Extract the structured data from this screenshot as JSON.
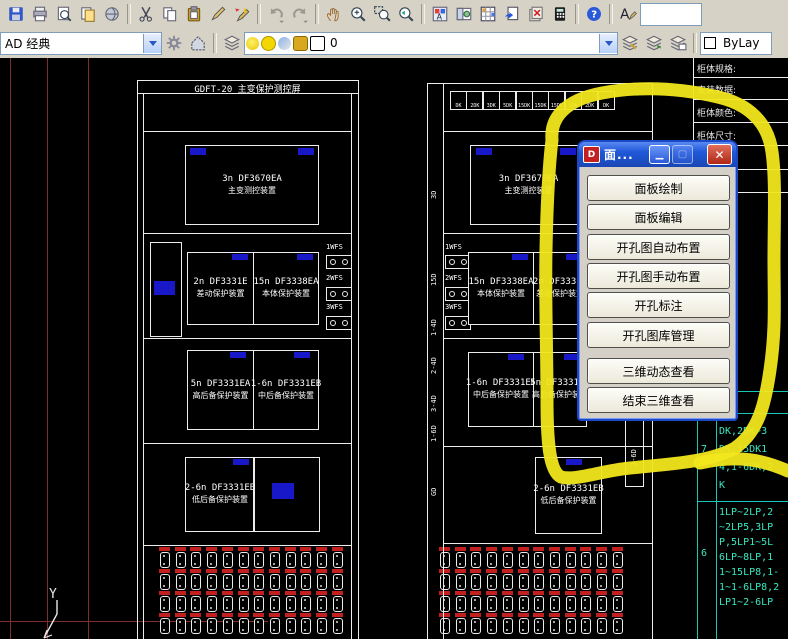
{
  "toolbars": {
    "standard_icons": [
      "save",
      "plot",
      "plot-preview",
      "publish",
      "etransmit",
      "|",
      "cut",
      "copy",
      "paste",
      "edit-pencil",
      "match-properties",
      "|",
      "undo",
      "redo",
      "|",
      "pan",
      "zoom-realtime",
      "zoom-window",
      "zoom-previous",
      "|",
      "properties",
      "designcenter",
      "tool-palettes",
      "sheet-set-manager",
      "markup-set-manager",
      "quickcalc",
      "|",
      "help",
      "|",
      "text-style"
    ],
    "workspace_value": "AD 经典",
    "row2_icons_left": [
      "workspace-settings",
      "my-workspace"
    ],
    "layer_toolbar_icon": "layer-properties-manager",
    "layer_combo": {
      "current_layer": "0",
      "state_icons": [
        "bulb-icon",
        "sun-icon",
        "viewport-freeze-icon",
        "lock-icon",
        "color-swatch"
      ]
    },
    "row2_icons_right": [
      "layer-make-current",
      "layer-previous",
      "layer-states-manager"
    ],
    "color_value": "ByLay"
  },
  "dialog": {
    "title": "面...",
    "buttons": [
      "面板绘制",
      "面板编辑",
      "开孔图自动布置",
      "开孔图手动布置",
      "开孔标注",
      "开孔图库管理",
      "三维动态查看",
      "结束三维查看"
    ]
  },
  "drawing": {
    "highlight_color": "#f2e71c",
    "panel_left": {
      "title": "GDFT-20 主变保护测控屏",
      "modules": [
        {
          "code": "3n DF3670EA",
          "name": "主变测控装置"
        },
        {
          "code": "2n DF3331E",
          "name": "差动保护装置"
        },
        {
          "code": "15n DF3338EA",
          "name": "本体保护装置"
        },
        {
          "code": "5n DF3331EA",
          "name": "高后备保护装置"
        },
        {
          "code": "1-6n DF3331EB",
          "name": "中后备保护装置"
        },
        {
          "code": "2-6n DF3331EB",
          "name": "低后备保护装置"
        }
      ],
      "wfs_labels": [
        "1WFS",
        "2WFS",
        "3WFS"
      ],
      "terminal_rows": 4,
      "terminals_per_row": 12
    },
    "panel_right": {
      "dk_boxes": [
        "DK",
        "2DK",
        "3DK",
        "5DK",
        "15DK",
        "15DK",
        "15DK",
        "1DK",
        "2DK",
        "DK"
      ],
      "side_labels": [
        "3D",
        "15D",
        "1-4D",
        "2-4D",
        "3-4D",
        "1-6D",
        "GD"
      ],
      "tag_2_6d": "2-6D",
      "wfs_labels": [
        "1WFS",
        "2WFS",
        "3WFS"
      ],
      "modules": [
        {
          "code": "3n DF3670EA",
          "name": "主变测控装置"
        },
        {
          "code": "15n DF3338EA",
          "name": "本体保护装置"
        },
        {
          "code": "2n DF3331E",
          "name": "差动保护装置"
        },
        {
          "code": "1-6n DF3331EB",
          "name": "中后备保护装置"
        },
        {
          "code": "5n DF3331EA",
          "name": "高后备保护装置"
        },
        {
          "code": "2-6n DF3331EB",
          "name": "低后备保护装置"
        }
      ],
      "terminal_rows": 4,
      "terminals_per_row": 12
    },
    "spec_table": {
      "rows": [
        "柜体规格:",
        "安装数据:",
        "柜体颜色:",
        "柜体尺寸:",
        "母线规格(",
        "规格 :"
      ]
    },
    "signal_table": {
      "header": "FS~3WF",
      "groups": [
        {
          "no": "7",
          "lines": [
            "DK,2DK~3",
            "DK,15DK1",
            "4,1-6DK,2",
            "K"
          ]
        },
        {
          "no": "6",
          "lines": [
            "1LP~2LP,2",
            "~2LP5,3LP",
            "P,5LP1~5L",
            "6LP~8LP,1",
            "1~15LP8,1-",
            "1~1-6LP8,2",
            "LP1~2-6LP"
          ]
        }
      ]
    },
    "ucs": {
      "y_label": "Y"
    }
  }
}
